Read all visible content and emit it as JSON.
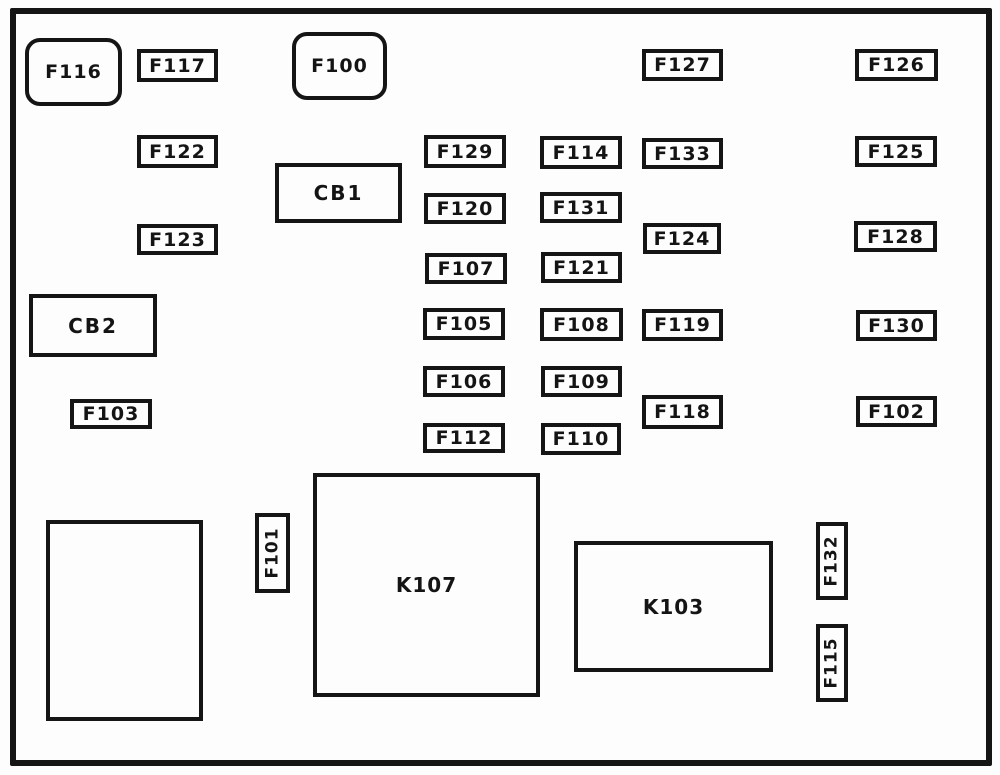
{
  "diagram": {
    "title": "fuse-box-diagram",
    "colors": {
      "line": "#151515",
      "background": "#fdfdfd"
    },
    "frame": {
      "x": 10,
      "y": 8,
      "w": 982,
      "h": 758
    },
    "boxes": [
      {
        "label": "F116",
        "type": "rounded",
        "x": 25,
        "y": 38,
        "w": 97,
        "h": 68
      },
      {
        "label": "F117",
        "type": "fuse",
        "x": 137,
        "y": 49,
        "w": 81,
        "h": 33
      },
      {
        "label": "F100",
        "type": "rounded",
        "x": 292,
        "y": 32,
        "w": 95,
        "h": 68
      },
      {
        "label": "F127",
        "type": "fuse",
        "x": 642,
        "y": 49,
        "w": 81,
        "h": 32
      },
      {
        "label": "F126",
        "type": "fuse",
        "x": 855,
        "y": 49,
        "w": 83,
        "h": 32
      },
      {
        "label": "F122",
        "type": "fuse",
        "x": 137,
        "y": 135,
        "w": 81,
        "h": 33
      },
      {
        "label": "F129",
        "type": "fuse",
        "x": 424,
        "y": 135,
        "w": 82,
        "h": 33
      },
      {
        "label": "F114",
        "type": "fuse",
        "x": 540,
        "y": 136,
        "w": 82,
        "h": 33
      },
      {
        "label": "F133",
        "type": "fuse",
        "x": 642,
        "y": 138,
        "w": 81,
        "h": 31
      },
      {
        "label": "F125",
        "type": "fuse",
        "x": 855,
        "y": 136,
        "w": 82,
        "h": 31
      },
      {
        "label": "CB1",
        "type": "breaker",
        "x": 275,
        "y": 163,
        "w": 127,
        "h": 60
      },
      {
        "label": "F120",
        "type": "fuse",
        "x": 424,
        "y": 193,
        "w": 82,
        "h": 31
      },
      {
        "label": "F131",
        "type": "fuse",
        "x": 540,
        "y": 192,
        "w": 82,
        "h": 31
      },
      {
        "label": "F123",
        "type": "fuse",
        "x": 137,
        "y": 224,
        "w": 81,
        "h": 31
      },
      {
        "label": "F124",
        "type": "fuse",
        "x": 643,
        "y": 223,
        "w": 78,
        "h": 31
      },
      {
        "label": "F128",
        "type": "fuse",
        "x": 854,
        "y": 221,
        "w": 83,
        "h": 31
      },
      {
        "label": "F107",
        "type": "fuse",
        "x": 425,
        "y": 253,
        "w": 82,
        "h": 31
      },
      {
        "label": "F121",
        "type": "fuse",
        "x": 541,
        "y": 252,
        "w": 81,
        "h": 31
      },
      {
        "label": "CB2",
        "type": "breaker",
        "x": 29,
        "y": 294,
        "w": 128,
        "h": 63
      },
      {
        "label": "F105",
        "type": "fuse",
        "x": 423,
        "y": 308,
        "w": 82,
        "h": 32
      },
      {
        "label": "F108",
        "type": "fuse",
        "x": 540,
        "y": 308,
        "w": 83,
        "h": 33
      },
      {
        "label": "F119",
        "type": "fuse",
        "x": 642,
        "y": 309,
        "w": 81,
        "h": 32
      },
      {
        "label": "F130",
        "type": "fuse",
        "x": 856,
        "y": 310,
        "w": 81,
        "h": 31
      },
      {
        "label": "F106",
        "type": "fuse",
        "x": 423,
        "y": 366,
        "w": 82,
        "h": 31
      },
      {
        "label": "F109",
        "type": "fuse",
        "x": 541,
        "y": 366,
        "w": 81,
        "h": 31
      },
      {
        "label": "F103",
        "type": "fuse",
        "x": 70,
        "y": 399,
        "w": 82,
        "h": 30
      },
      {
        "label": "F118",
        "type": "fuse",
        "x": 642,
        "y": 395,
        "w": 81,
        "h": 34
      },
      {
        "label": "F102",
        "type": "fuse",
        "x": 856,
        "y": 396,
        "w": 81,
        "h": 31
      },
      {
        "label": "F112",
        "type": "fuse",
        "x": 423,
        "y": 423,
        "w": 82,
        "h": 30
      },
      {
        "label": "F110",
        "type": "fuse",
        "x": 541,
        "y": 423,
        "w": 80,
        "h": 32
      },
      {
        "label": "",
        "type": "blank",
        "x": 46,
        "y": 520,
        "w": 157,
        "h": 201
      },
      {
        "label": "F101",
        "type": "vertical",
        "x": 255,
        "y": 513,
        "w": 35,
        "h": 80
      },
      {
        "label": "K107",
        "type": "relay",
        "x": 313,
        "y": 473,
        "w": 227,
        "h": 224
      },
      {
        "label": "K103",
        "type": "relay",
        "x": 574,
        "y": 541,
        "w": 199,
        "h": 131
      },
      {
        "label": "F132",
        "type": "vertical",
        "x": 816,
        "y": 522,
        "w": 32,
        "h": 78
      },
      {
        "label": "F115",
        "type": "vertical",
        "x": 816,
        "y": 624,
        "w": 32,
        "h": 78
      }
    ]
  }
}
